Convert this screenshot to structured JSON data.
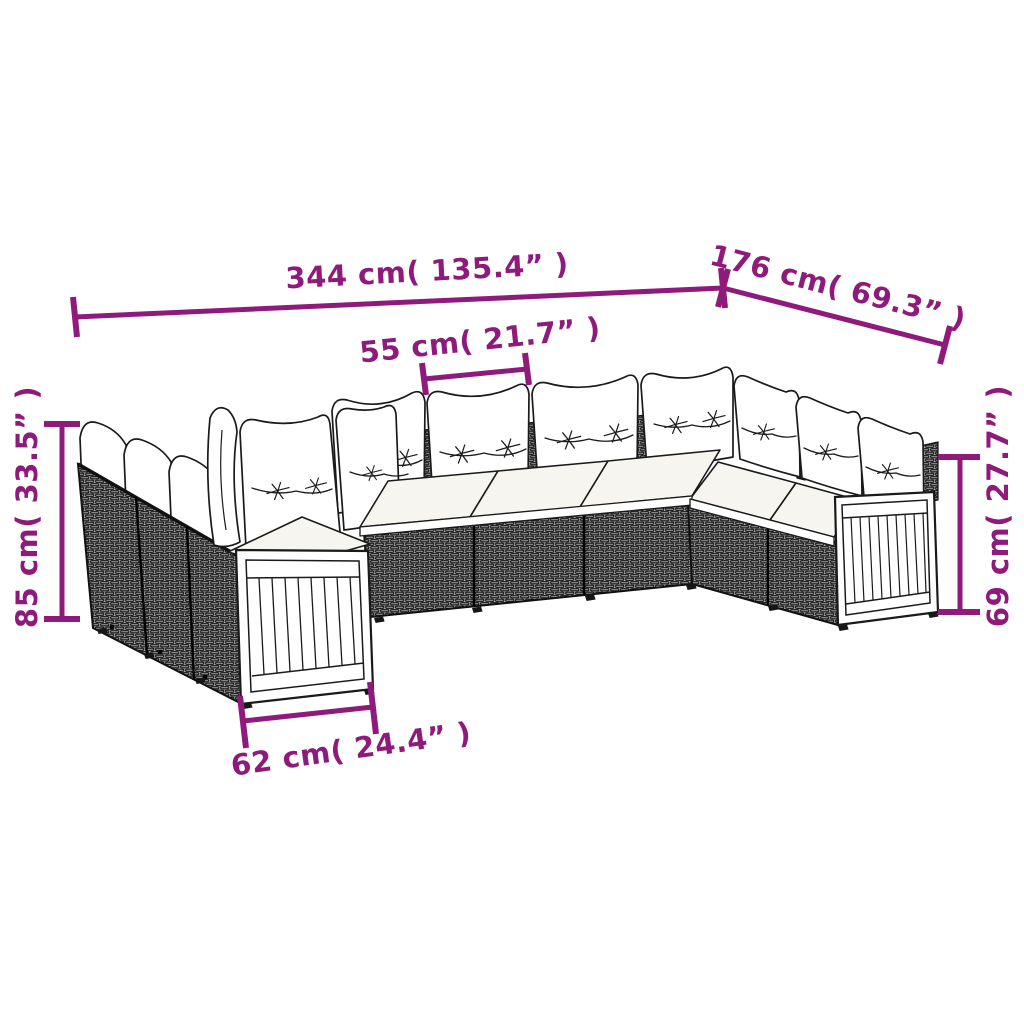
{
  "diagram": {
    "kind": "product-dimension-diagram",
    "subject_icon": "garden-sofa-set-line-art"
  },
  "dimensions": {
    "overall_width": {
      "cm": 344,
      "in": 135.4,
      "label": "344 cm( 135.4” )"
    },
    "overall_depth": {
      "cm": 176,
      "in": 69.3,
      "label": "176 cm( 69.3” )"
    },
    "cushion_width": {
      "cm": 55,
      "in": 21.7,
      "label": "55 cm( 21.7” )"
    },
    "back_height": {
      "cm": 85,
      "in": 33.5,
      "label": "85 cm( 33.5” )"
    },
    "arm_height": {
      "cm": 69,
      "in": 27.7,
      "label": "69 cm( 27.7” )"
    },
    "module_depth": {
      "cm": 62,
      "in": 24.4,
      "label": "62 cm( 24.4” )"
    }
  },
  "colors": {
    "dimension_accent": "#8e1b7b",
    "line_art": "#1a1a1a",
    "background": "#ffffff",
    "rattan_tone": "#a8a8a8",
    "cushion_fill": "#ffffff"
  }
}
